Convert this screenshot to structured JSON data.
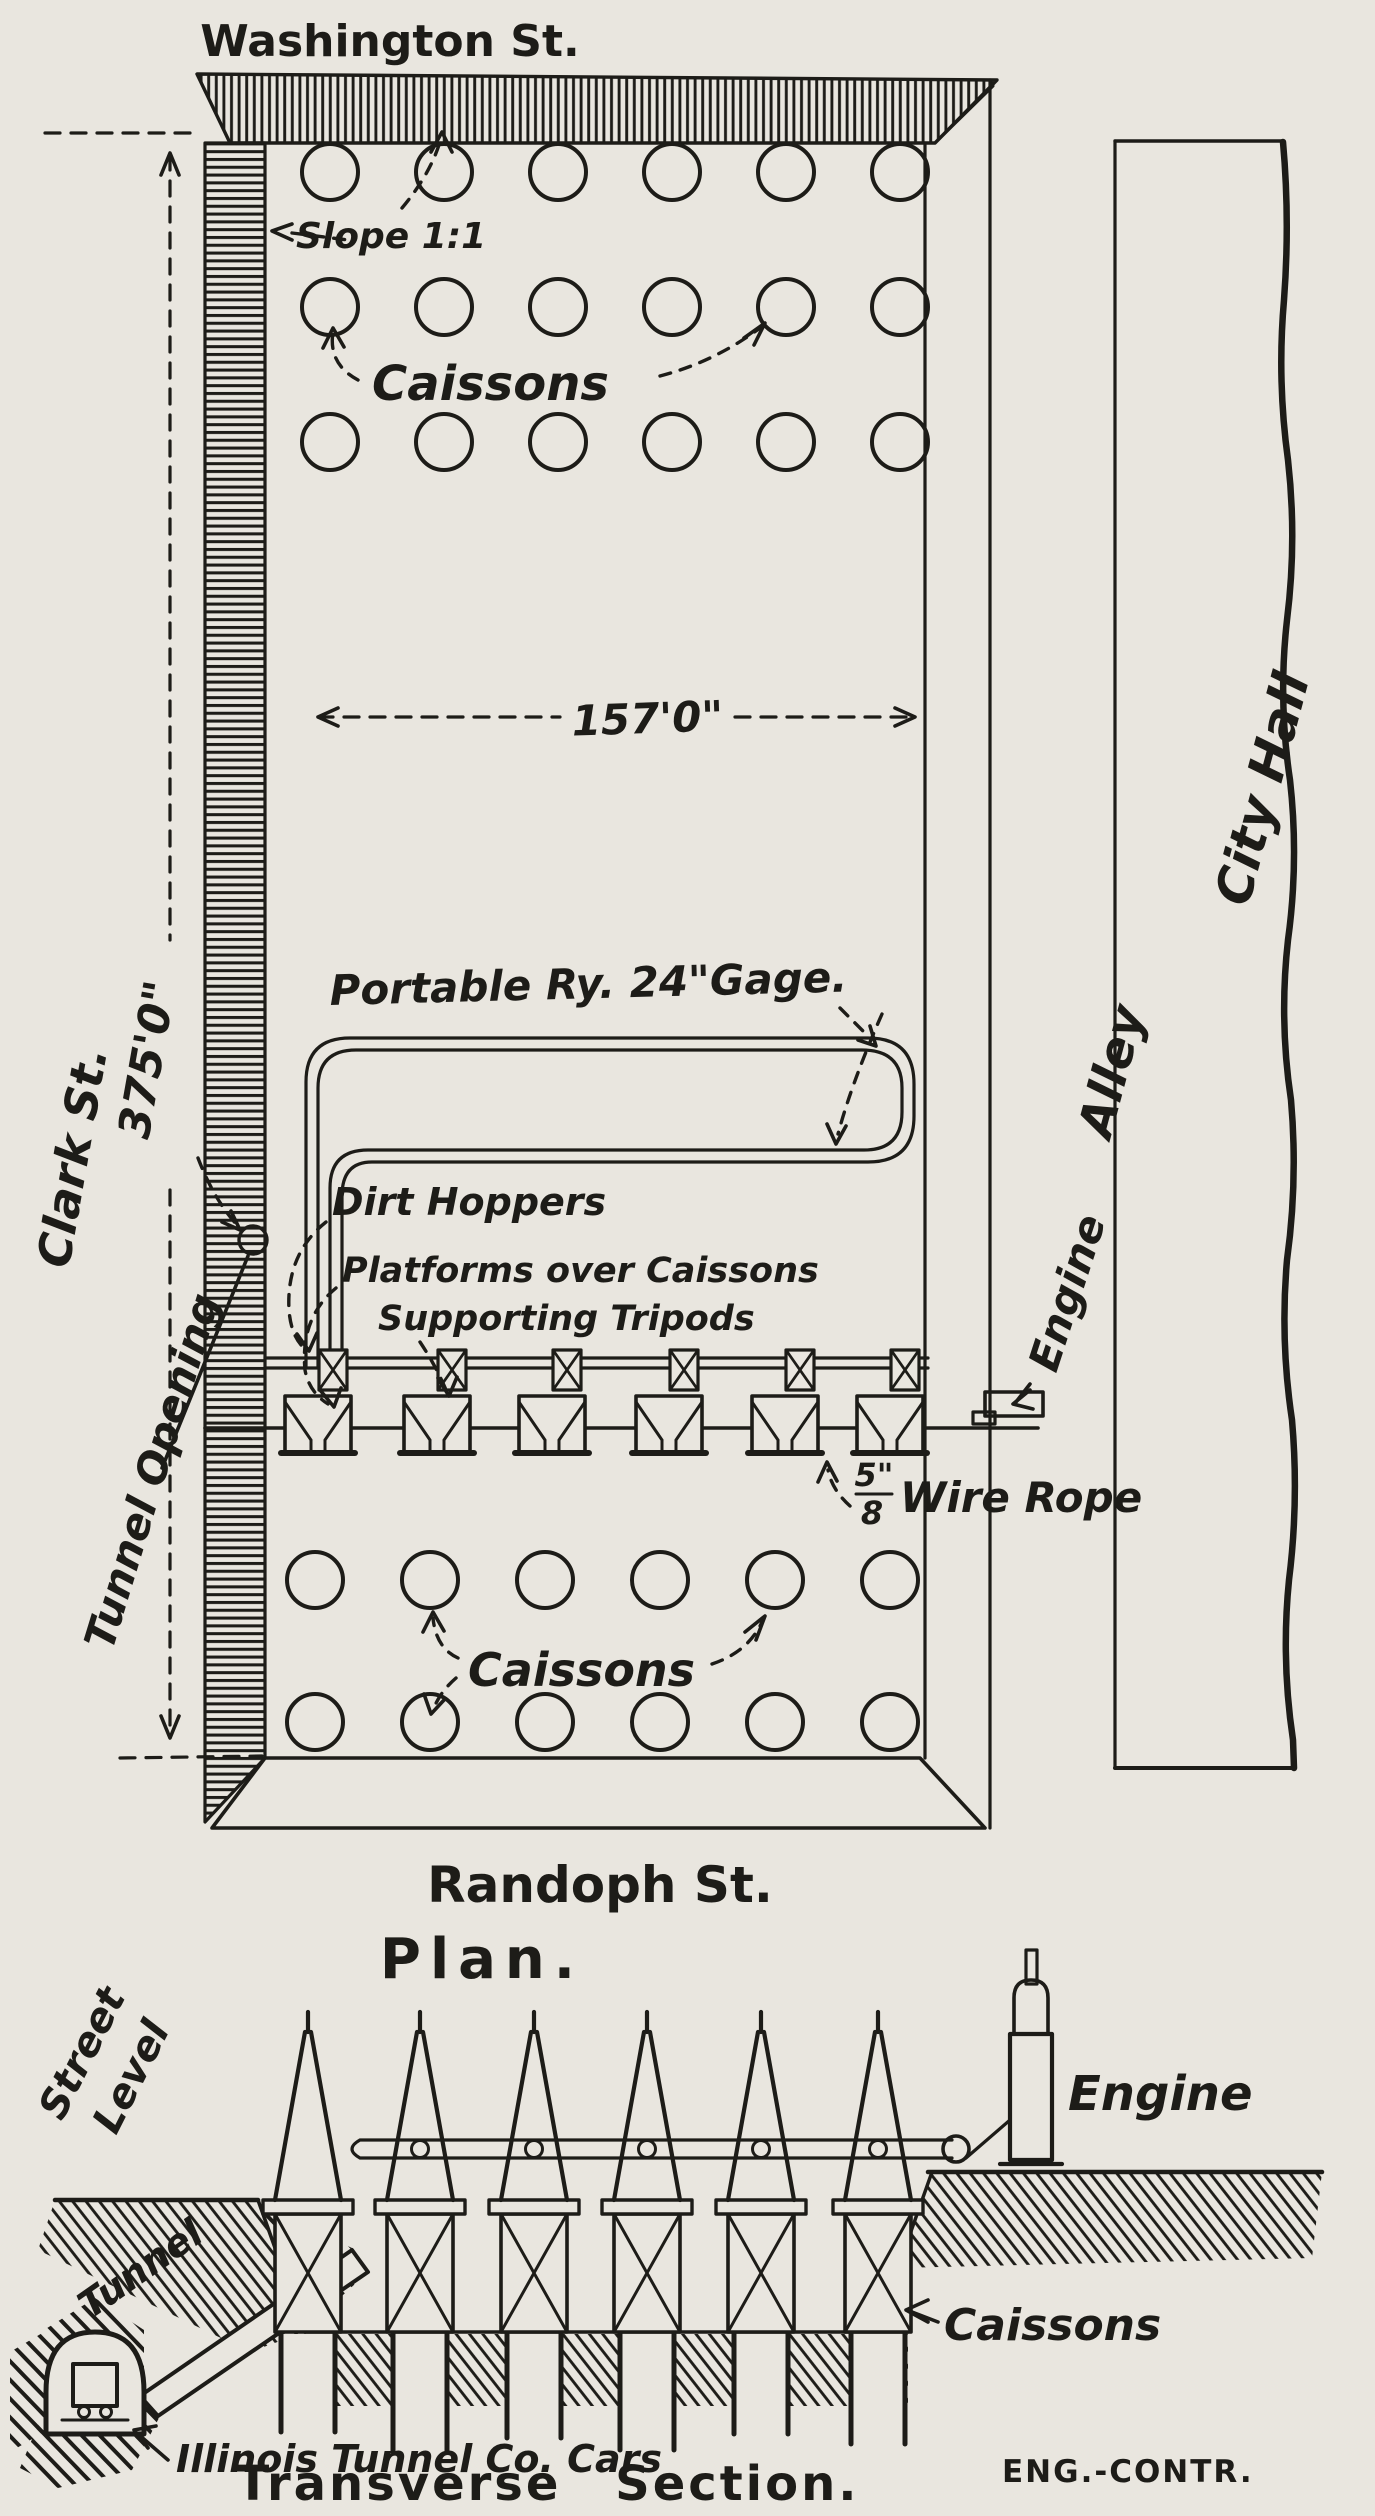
{
  "title": "Caisson excavation drawing - Plan and Transverse Section",
  "colors": {
    "paper": "#e9e6df",
    "ink": "#1d1c18"
  },
  "plan": {
    "title": "Plan.",
    "street_top": "Washington St.",
    "street_left": "Clark St.",
    "street_bottom": "Randoph St.",
    "dim_width": "157'0\"",
    "dim_height": "375'0\"",
    "slope": "Slope 1:1",
    "caissons_top": "Caissons",
    "caissons_bottom": "Caissons",
    "portable_ry": "Portable Ry. 24\"Gage.",
    "dirt_hoppers": "Dirt Hoppers",
    "platforms": "Platforms over Caissons",
    "tripods": "Supporting Tripods",
    "rope_num": "5\"",
    "rope_den": "8",
    "rope": "Wire Rope",
    "tunnel_opening": "Tunnel Opening",
    "engine": "Engine",
    "alley": "Alley",
    "city_hall": "City Hall",
    "structure": {
      "caisson_columns": 6,
      "caisson_rows_top": 3,
      "caisson_rows_bottom": 2,
      "hopper_units": 6
    }
  },
  "section": {
    "title": "Transverse Section.",
    "street_level": [
      "Street",
      "Level"
    ],
    "tunnel": "Tunnel",
    "engine": "Engine",
    "caissons": "Caissons",
    "cars": "Illinois Tunnel Co. Cars",
    "credit": "ENG.-CONTR.",
    "structure": {
      "tripods": 6,
      "caisson_shafts": 6
    }
  }
}
